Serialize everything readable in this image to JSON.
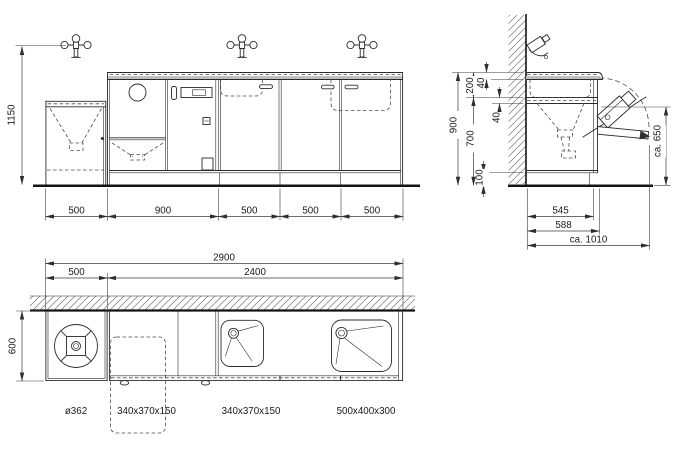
{
  "front_view": {
    "height": "1150",
    "widths": [
      "500",
      "900",
      "500",
      "500",
      "500"
    ]
  },
  "side_view": {
    "height_total": "900",
    "counter_thickness": "40",
    "splash_zone": "200",
    "apron": "40",
    "underbody": "700",
    "plinth": "100",
    "flap_height": "ca. 650",
    "depth_body": "545",
    "depth_counter": "588",
    "depth_open": "ca. 1010"
  },
  "plan_view": {
    "width_total": "2900",
    "width_left_unit": "500",
    "width_main": "2400",
    "depth": "600",
    "items": [
      "ø362",
      "340x370x150",
      "340x370x150",
      "500x400x300"
    ]
  }
}
